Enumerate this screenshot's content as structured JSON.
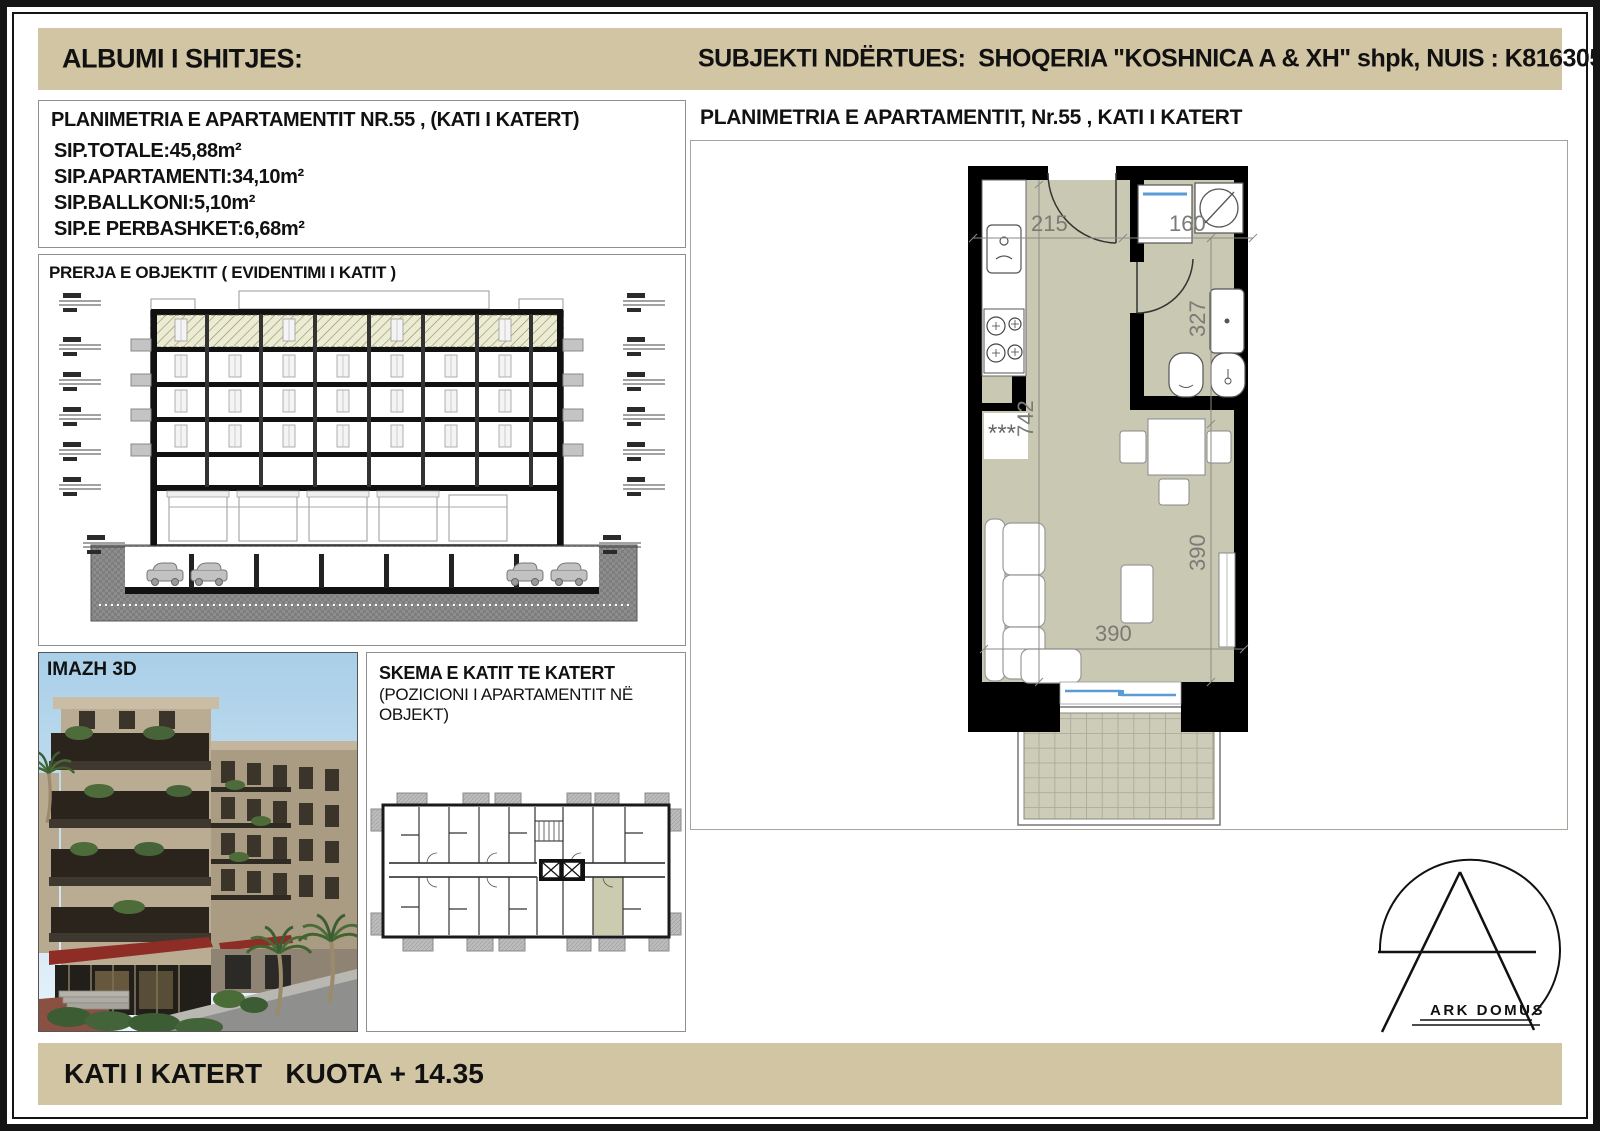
{
  "header": {
    "left_title": "ALBUMI I SHITJES:",
    "right_title": "SUBJEKTI NDËRTUES:  SHOQERIA \"KOSHNICA A & XH\" shpk, NUIS : K81630502E"
  },
  "apartment_info": {
    "title": "PLANIMETRIA E APARTAMENTIT NR.55 , (KATI I KATERT)",
    "area_total": "SIP.TOTALE:45,88m²",
    "area_apartment": "SIP.APARTAMENTI:34,10m²",
    "area_balcony": "SIP.BALLKONI:5,10m²",
    "area_common": "SIP.E PERBASHKET:6,68m²"
  },
  "section_panel": {
    "title": "PRERJA E OBJEKTIT ( EVIDENTIMI I KATIT )"
  },
  "image_panel": {
    "label": "IMAZH 3D"
  },
  "schema_panel": {
    "title": "SKEMA E KATIT TE KATERT",
    "subtitle": "(POZICIONI I APARTAMENTIT NË OBJEKT)"
  },
  "plan_panel": {
    "title": "PLANIMETRIA E APARTAMENTIT, Nr.55 , KATI I KATERT",
    "dims": {
      "hall_width": "215",
      "bath_width": "160",
      "bath_depth": "327",
      "apartment_depth": "742",
      "room_depth": "390",
      "room_width": "390"
    },
    "radiator_mark": "***"
  },
  "logo": {
    "name": "ARK DOMUS"
  },
  "footer": {
    "text": "KATI I KATERT   KUOTA + 14.35"
  },
  "colors": {
    "band": "#d2c5a4",
    "plan_floor": "#c9c8b2",
    "balcony_tile": "#cdccb8",
    "wall": "#000000",
    "window_blue": "#5b9bd5",
    "schema_highlight": "#cbcbb0"
  }
}
